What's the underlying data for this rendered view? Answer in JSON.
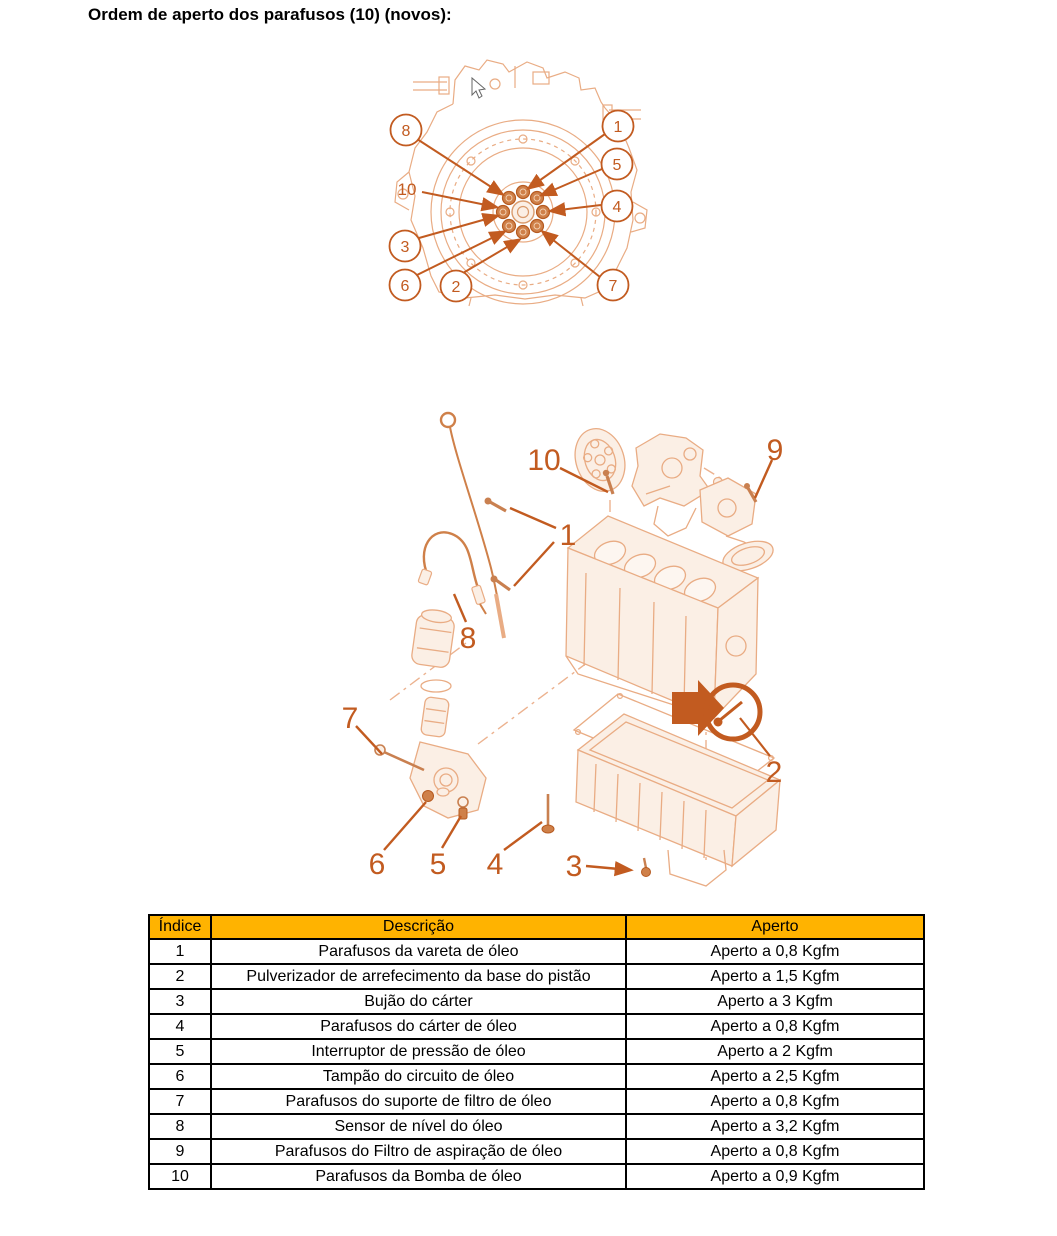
{
  "title": "Ordem de aperto dos parafusos (10) (novos):",
  "colors": {
    "accent_orange": "#C25B20",
    "hardware_orange": "#C98050",
    "sketch_line": "#E9AC84",
    "sketch_fill": "#FBEFE5",
    "table_header_bg": "#FFB300",
    "table_border": "#000000",
    "text": "#000000"
  },
  "diagram1": {
    "name": "Ordem de aperto dos parafusos do volante do motor",
    "callouts": {
      "c8": "8",
      "c1": "1",
      "c5": "5",
      "c4": "4",
      "c10": "10",
      "c3": "3",
      "c6": "6",
      "c2": "2",
      "c7": "7"
    }
  },
  "diagram2": {
    "name": "Vista explodida do circuito de óleo do motor",
    "callouts": {
      "c10": "10",
      "c9": "9",
      "c1": "1",
      "c8": "8",
      "c7": "7",
      "c6": "6",
      "c5": "5",
      "c4": "4",
      "c3": "3",
      "c2": "2"
    }
  },
  "table": {
    "headers": {
      "indice": "Índice",
      "descricao": "Descrição",
      "aperto": "Aperto"
    },
    "rows": [
      {
        "indice": "1",
        "descricao": "Parafusos da vareta de óleo",
        "aperto": "Aperto a 0,8 Kgfm"
      },
      {
        "indice": "2",
        "descricao": "Pulverizador de arrefecimento da base do pistão",
        "aperto": "Aperto a 1,5 Kgfm"
      },
      {
        "indice": "3",
        "descricao": "Bujão do cárter",
        "aperto": "Aperto a 3 Kgfm"
      },
      {
        "indice": "4",
        "descricao": "Parafusos do cárter de óleo",
        "aperto": "Aperto a 0,8 Kgfm"
      },
      {
        "indice": "5",
        "descricao": "Interruptor de pressão de óleo",
        "aperto": "Aperto a 2 Kgfm"
      },
      {
        "indice": "6",
        "descricao": "Tampão do circuito de óleo",
        "aperto": "Aperto a 2,5 Kgfm"
      },
      {
        "indice": "7",
        "descricao": "Parafusos do suporte de filtro de óleo",
        "aperto": "Aperto a 0,8 Kgfm"
      },
      {
        "indice": "8",
        "descricao": "Sensor de nível do óleo",
        "aperto": "Aperto a 3,2 Kgfm"
      },
      {
        "indice": "9",
        "descricao": "Parafusos do Filtro de aspiração de óleo",
        "aperto": "Aperto a 0,8 Kgfm"
      },
      {
        "indice": "10",
        "descricao": "Parafusos da Bomba de óleo",
        "aperto": "Aperto a 0,9 Kgfm"
      }
    ]
  }
}
